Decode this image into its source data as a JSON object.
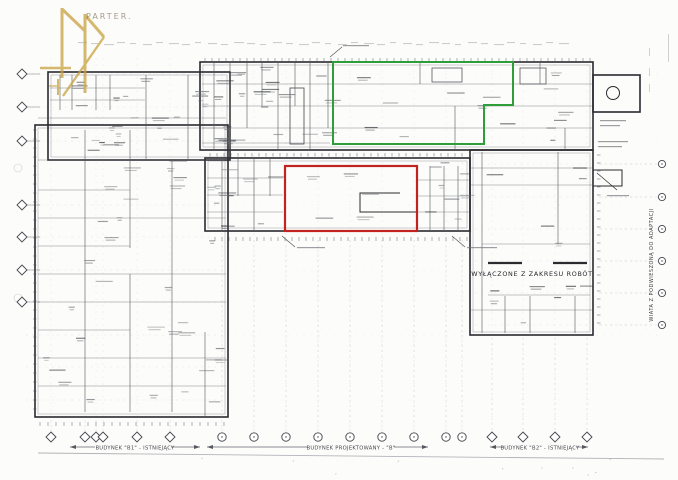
{
  "plan": {
    "floor_label": "PARTER.",
    "excluded_label": "WYŁĄCZONE Z ZAKRESU ROBÓT",
    "canopy_label": "WIATA Z PODWIESZONĄ DO ADAPTACJI",
    "footer": {
      "left": "BUDYNEK \"B1\" - ISTNIEJĄCY",
      "center": "BUDYNEK PROJEKTOWANY - \"B\"",
      "right": "BUDYNEK \"B2\" - ISTNIEJĄCY"
    },
    "colors": {
      "highlight_green": "#2f9e3a",
      "highlight_red": "#c1241f",
      "wall": "#2b2b30",
      "partition": "#55585e",
      "grid": "#9aa3b0",
      "watermark": "#c9a23f",
      "paper": "#fcfcfa",
      "annotation": "#686c72",
      "annotation_dark": "#34373c"
    }
  }
}
